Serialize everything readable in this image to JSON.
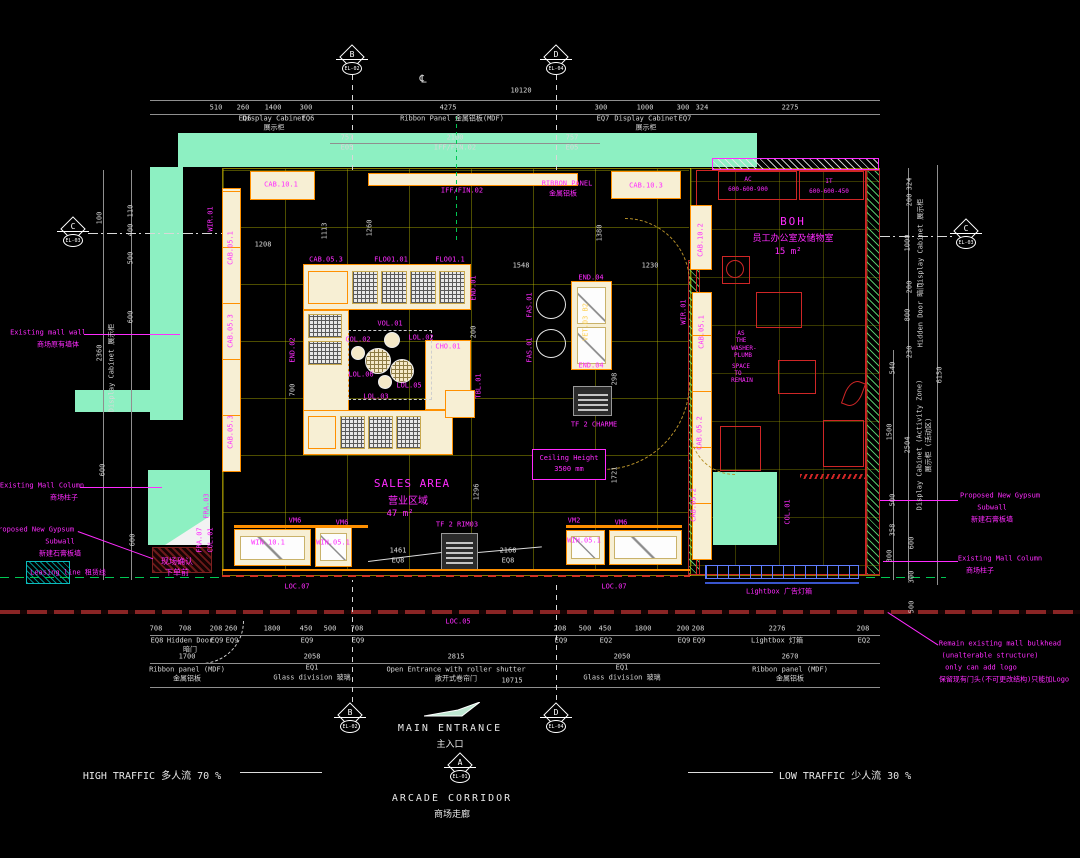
{
  "colors": {
    "wall_green": "#8df0c2",
    "magenta": "#ff00ff",
    "cad_yellow": "#ffff00",
    "cabinet_fill": "#f7efd4",
    "cabinet_border": "#ff9000",
    "red": "#cf2626",
    "lightbox_blue": "#5f7dff",
    "leasing_green": "#00c853"
  },
  "markers": [
    {
      "letter": "B",
      "code": "EL-02"
    },
    {
      "letter": "D",
      "code": "EL-04"
    },
    {
      "letter": "C",
      "code": "EL-03"
    },
    {
      "letter": "C",
      "code": "EL-03"
    },
    {
      "letter": "B",
      "code": "EL-02"
    },
    {
      "letter": "D",
      "code": "EL-04"
    },
    {
      "letter": "A",
      "code": "EL-01"
    }
  ],
  "traffic": {
    "high": "HIGH TRAFFIC 多人流 70 %",
    "low": "LOW TRAFFIC 少人流 30 %"
  },
  "entrance": {
    "main": "MAIN ENTRANCE",
    "main_cn": "主入口",
    "corridor": "ARCADE CORRIDOR",
    "corridor_cn": "商场走廊"
  },
  "rooms": {
    "sales": {
      "name": "SALES AREA",
      "cn": "营业区域",
      "area": "47 m²"
    },
    "boh": {
      "name": "BOH",
      "cn": "员工办公室及储物室",
      "area": "15 m²"
    },
    "ceiling": {
      "l1": "Ceiling Height",
      "l2": "3500 mm"
    }
  },
  "labels": [
    {
      "t": "10120",
      "x": 521,
      "y": 91
    },
    {
      "t": "510",
      "x": 216,
      "y": 108
    },
    {
      "t": "260",
      "x": 243,
      "y": 108
    },
    {
      "t": "EQ6",
      "x": 245,
      "y": 119
    },
    {
      "t": "1400",
      "x": 273,
      "y": 108
    },
    {
      "t": "Display Cabinet",
      "x": 274,
      "y": 119
    },
    {
      "t": "展示柜",
      "x": 274,
      "y": 128
    },
    {
      "t": "300",
      "x": 306,
      "y": 108
    },
    {
      "t": "EQ6",
      "x": 308,
      "y": 119
    },
    {
      "t": "757",
      "x": 347,
      "y": 138
    },
    {
      "t": "E05",
      "x": 347,
      "y": 148
    },
    {
      "t": "4275",
      "x": 448,
      "y": 108
    },
    {
      "t": "Ribbon Panel 金属铝板(MDF)",
      "x": 452,
      "y": 119
    },
    {
      "t": "2100",
      "x": 455,
      "y": 138
    },
    {
      "t": "IFF/FIN.02",
      "x": 455,
      "y": 148
    },
    {
      "t": "757",
      "x": 572,
      "y": 138
    },
    {
      "t": "E05",
      "x": 572,
      "y": 148
    },
    {
      "t": "300",
      "x": 601,
      "y": 108
    },
    {
      "t": "EQ7",
      "x": 603,
      "y": 119
    },
    {
      "t": "1000",
      "x": 645,
      "y": 108
    },
    {
      "t": "Display Cabinet",
      "x": 646,
      "y": 119
    },
    {
      "t": "展示柜",
      "x": 646,
      "y": 128
    },
    {
      "t": "300",
      "x": 683,
      "y": 108
    },
    {
      "t": "EQ7",
      "x": 685,
      "y": 119
    },
    {
      "t": "324",
      "x": 702,
      "y": 108
    },
    {
      "t": "2275",
      "x": 790,
      "y": 108
    },
    {
      "t": "℄",
      "x": 423,
      "y": 79,
      "s": 11
    },
    {
      "t": "100",
      "x": 100,
      "y": 218,
      "r": 1
    },
    {
      "t": "110",
      "x": 131,
      "y": 211,
      "r": 1
    },
    {
      "t": "400",
      "x": 131,
      "y": 230,
      "r": 1
    },
    {
      "t": "500",
      "x": 131,
      "y": 258,
      "r": 1
    },
    {
      "t": "600",
      "x": 131,
      "y": 317,
      "r": 1
    },
    {
      "t": "2360",
      "x": 100,
      "y": 353,
      "r": 1
    },
    {
      "t": "Display Cabinet 展示柜",
      "x": 112,
      "y": 368,
      "r": 1
    },
    {
      "t": "600",
      "x": 103,
      "y": 470,
      "r": 1
    },
    {
      "t": "600",
      "x": 133,
      "y": 540,
      "r": 1
    },
    {
      "t": "324",
      "x": 910,
      "y": 184,
      "r": 1
    },
    {
      "t": "200",
      "x": 910,
      "y": 200,
      "r": 1
    },
    {
      "t": "1000",
      "x": 908,
      "y": 243,
      "r": 1
    },
    {
      "t": "Display Cabinet 展示柜",
      "x": 921,
      "y": 243,
      "r": 1
    },
    {
      "t": "200",
      "x": 910,
      "y": 287,
      "r": 1
    },
    {
      "t": "800",
      "x": 908,
      "y": 315,
      "r": 1
    },
    {
      "t": "Hidden Door 暗门",
      "x": 921,
      "y": 315,
      "r": 1
    },
    {
      "t": "230",
      "x": 910,
      "y": 352,
      "r": 1
    },
    {
      "t": "540",
      "x": 893,
      "y": 368,
      "r": 1
    },
    {
      "t": "6150",
      "x": 940,
      "y": 375,
      "r": 1
    },
    {
      "t": "1500",
      "x": 890,
      "y": 432,
      "r": 1
    },
    {
      "t": "2504",
      "x": 908,
      "y": 445,
      "r": 1
    },
    {
      "t": "Display Cabinet (Activity Zone)",
      "x": 920,
      "y": 445,
      "r": 1
    },
    {
      "t": "展示柜 (活动区)",
      "x": 929,
      "y": 445,
      "r": 1
    },
    {
      "t": "500",
      "x": 893,
      "y": 500,
      "r": 1
    },
    {
      "t": "358",
      "x": 893,
      "y": 530,
      "r": 1
    },
    {
      "t": "300",
      "x": 890,
      "y": 556,
      "r": 1
    },
    {
      "t": "600",
      "x": 912,
      "y": 543,
      "r": 1
    },
    {
      "t": "300",
      "x": 912,
      "y": 577,
      "r": 1
    },
    {
      "t": "500",
      "x": 912,
      "y": 607,
      "r": 1
    },
    {
      "t": "708",
      "x": 156,
      "y": 629
    },
    {
      "t": "EQ8",
      "x": 157,
      "y": 641
    },
    {
      "t": "708",
      "x": 185,
      "y": 629
    },
    {
      "t": "Hidden Door",
      "x": 190,
      "y": 641
    },
    {
      "t": "暗门",
      "x": 190,
      "y": 650
    },
    {
      "t": "208",
      "x": 216,
      "y": 629
    },
    {
      "t": "EQ9",
      "x": 217,
      "y": 641
    },
    {
      "t": "260",
      "x": 231,
      "y": 629
    },
    {
      "t": "EQ9",
      "x": 232,
      "y": 641
    },
    {
      "t": "1800",
      "x": 272,
      "y": 629
    },
    {
      "t": "450",
      "x": 306,
      "y": 629
    },
    {
      "t": "EQ9",
      "x": 307,
      "y": 641
    },
    {
      "t": "500",
      "x": 330,
      "y": 629
    },
    {
      "t": "708",
      "x": 357,
      "y": 629
    },
    {
      "t": "EQ9",
      "x": 358,
      "y": 641
    },
    {
      "t": "208",
      "x": 560,
      "y": 629
    },
    {
      "t": "EQ9",
      "x": 561,
      "y": 641
    },
    {
      "t": "500",
      "x": 585,
      "y": 629
    },
    {
      "t": "450",
      "x": 605,
      "y": 629
    },
    {
      "t": "EQ2",
      "x": 606,
      "y": 641
    },
    {
      "t": "1800",
      "x": 643,
      "y": 629
    },
    {
      "t": "200",
      "x": 683,
      "y": 629
    },
    {
      "t": "EQ9",
      "x": 684,
      "y": 641
    },
    {
      "t": "208",
      "x": 698,
      "y": 629
    },
    {
      "t": "EQ9",
      "x": 699,
      "y": 641
    },
    {
      "t": "2276",
      "x": 777,
      "y": 629
    },
    {
      "t": "Lightbox 灯箱",
      "x": 777,
      "y": 641
    },
    {
      "t": "208",
      "x": 863,
      "y": 629
    },
    {
      "t": "EQ2",
      "x": 864,
      "y": 641
    },
    {
      "t": "1700",
      "x": 187,
      "y": 657
    },
    {
      "t": "Ribbon panel (MDF)",
      "x": 187,
      "y": 670
    },
    {
      "t": "金属铝板",
      "x": 187,
      "y": 679
    },
    {
      "t": "2058",
      "x": 312,
      "y": 657
    },
    {
      "t": "EQ1",
      "x": 312,
      "y": 668
    },
    {
      "t": "Glass division 玻璃",
      "x": 312,
      "y": 678
    },
    {
      "t": "2815",
      "x": 456,
      "y": 657
    },
    {
      "t": "Open Entrance with roller shutter",
      "x": 456,
      "y": 670
    },
    {
      "t": "敞开式卷帘门",
      "x": 456,
      "y": 679
    },
    {
      "t": "2050",
      "x": 622,
      "y": 657
    },
    {
      "t": "EQ1",
      "x": 622,
      "y": 668
    },
    {
      "t": "Glass division 玻璃",
      "x": 622,
      "y": 678
    },
    {
      "t": "2670",
      "x": 790,
      "y": 657
    },
    {
      "t": "Ribbon panel (MDF)",
      "x": 790,
      "y": 670
    },
    {
      "t": "金属铝板",
      "x": 790,
      "y": 679
    },
    {
      "t": "10715",
      "x": 512,
      "y": 681
    },
    {
      "t": "1208",
      "x": 263,
      "y": 245
    },
    {
      "t": "1113",
      "x": 325,
      "y": 231,
      "r": 1
    },
    {
      "t": "1260",
      "x": 370,
      "y": 228,
      "r": 1
    },
    {
      "t": "1548",
      "x": 521,
      "y": 266
    },
    {
      "t": "1230",
      "x": 650,
      "y": 266
    },
    {
      "t": "1380",
      "x": 600,
      "y": 233,
      "r": 1
    },
    {
      "t": "700",
      "x": 293,
      "y": 390,
      "r": 1
    },
    {
      "t": "200",
      "x": 474,
      "y": 332,
      "r": 1
    },
    {
      "t": "298",
      "x": 615,
      "y": 379,
      "r": 1
    },
    {
      "t": "1461",
      "x": 398,
      "y": 551
    },
    {
      "t": "EQ8",
      "x": 398,
      "y": 561
    },
    {
      "t": "2168",
      "x": 508,
      "y": 551
    },
    {
      "t": "EQ8",
      "x": 508,
      "y": 561
    },
    {
      "t": "1296",
      "x": 477,
      "y": 492,
      "r": 1
    },
    {
      "t": "1721",
      "x": 615,
      "y": 475,
      "r": 1
    },
    {
      "t": "CAB.10.1",
      "x": 281,
      "y": 185,
      "c": "m",
      "n": "cab-10-1-label"
    },
    {
      "t": "RIBBON PANEL",
      "x": 567,
      "y": 184,
      "c": "m"
    },
    {
      "t": "金属铝板",
      "x": 563,
      "y": 194,
      "c": "m"
    },
    {
      "t": "IFF/FIN.02",
      "x": 462,
      "y": 191,
      "c": "m"
    },
    {
      "t": "CAB.10.3",
      "x": 646,
      "y": 186,
      "c": "m"
    },
    {
      "t": "CAB.10.2",
      "x": 701,
      "y": 240,
      "c": "m",
      "r": 1
    },
    {
      "t": "WIR.01",
      "x": 211,
      "y": 219,
      "c": "m",
      "r": 1
    },
    {
      "t": "CAB.05.1",
      "x": 231,
      "y": 248,
      "c": "m",
      "r": 1
    },
    {
      "t": "CAB.05.3",
      "x": 231,
      "y": 331,
      "c": "m",
      "r": 1
    },
    {
      "t": "CAB.05.3",
      "x": 231,
      "y": 432,
      "c": "m",
      "r": 1
    },
    {
      "t": "CAB.05.3",
      "x": 326,
      "y": 260,
      "c": "m"
    },
    {
      "t": "FLO01.01",
      "x": 391,
      "y": 260,
      "c": "m"
    },
    {
      "t": "FLO01.1",
      "x": 450,
      "y": 260,
      "c": "m"
    },
    {
      "t": "END.01",
      "x": 474,
      "y": 288,
      "c": "m",
      "r": 1
    },
    {
      "t": "END.02",
      "x": 293,
      "y": 350,
      "c": "m",
      "r": 1
    },
    {
      "t": "VOL.01",
      "x": 390,
      "y": 324,
      "c": "m"
    },
    {
      "t": "COL.02",
      "x": 358,
      "y": 340,
      "c": "m"
    },
    {
      "t": "LOL.02",
      "x": 421,
      "y": 338,
      "c": "m"
    },
    {
      "t": "CHO.01",
      "x": 448,
      "y": 347,
      "c": "m"
    },
    {
      "t": "LOL.06",
      "x": 361,
      "y": 375,
      "c": "m"
    },
    {
      "t": "LOL.05",
      "x": 409,
      "y": 386,
      "c": "m"
    },
    {
      "t": "LOL.03",
      "x": 376,
      "y": 397,
      "c": "m"
    },
    {
      "t": "TBL.01",
      "x": 479,
      "y": 386,
      "c": "m",
      "r": 1
    },
    {
      "t": "END.04",
      "x": 591,
      "y": 278,
      "c": "m"
    },
    {
      "t": "END.04",
      "x": 591,
      "y": 366,
      "c": "m"
    },
    {
      "t": "VET.03 B2",
      "x": 586,
      "y": 322,
      "c": "y",
      "r": 1
    },
    {
      "t": "FAS.01",
      "x": 530,
      "y": 305,
      "c": "m",
      "r": 1
    },
    {
      "t": "FAS.01",
      "x": 530,
      "y": 350,
      "c": "m",
      "r": 1
    },
    {
      "t": "TF 2 CHARME",
      "x": 594,
      "y": 425,
      "c": "m"
    },
    {
      "t": "WIR.01",
      "x": 684,
      "y": 312,
      "c": "m",
      "r": 1
    },
    {
      "t": "CAB.05.1",
      "x": 702,
      "y": 332,
      "c": "m",
      "r": 1
    },
    {
      "t": "CAB.05.2",
      "x": 700,
      "y": 433,
      "c": "m",
      "r": 1
    },
    {
      "t": "CAB.05.2",
      "x": 694,
      "y": 505,
      "c": "m",
      "r": 1
    },
    {
      "t": "VM6",
      "x": 295,
      "y": 521,
      "c": "m"
    },
    {
      "t": "VM6",
      "x": 342,
      "y": 523,
      "c": "m"
    },
    {
      "t": "WIN.10.1",
      "x": 268,
      "y": 543,
      "c": "m"
    },
    {
      "t": "WIN.05.1",
      "x": 333,
      "y": 543,
      "c": "m"
    },
    {
      "t": "TF 2 RIM03",
      "x": 457,
      "y": 525,
      "c": "m"
    },
    {
      "t": "VM2",
      "x": 574,
      "y": 521,
      "c": "m"
    },
    {
      "t": "VM6",
      "x": 621,
      "y": 523,
      "c": "m"
    },
    {
      "t": "WIH.05.1",
      "x": 584,
      "y": 541,
      "c": "m"
    },
    {
      "t": "LOC.07",
      "x": 297,
      "y": 587,
      "c": "m"
    },
    {
      "t": "LOC.07",
      "x": 614,
      "y": 587,
      "c": "m"
    },
    {
      "t": "LOC.05",
      "x": 458,
      "y": 622,
      "c": "m"
    },
    {
      "t": "Lightbox 广告灯箱",
      "x": 779,
      "y": 592,
      "c": "m"
    },
    {
      "t": "FRA.03",
      "x": 207,
      "y": 506,
      "c": "m",
      "r": 1
    },
    {
      "t": "FRA.07",
      "x": 200,
      "y": 540,
      "c": "m",
      "r": 1
    },
    {
      "t": "COL.01",
      "x": 211,
      "y": 540,
      "c": "m",
      "r": 1
    },
    {
      "t": "COL.01",
      "x": 788,
      "y": 512,
      "c": "m",
      "r": 1
    },
    {
      "t": "现场确认",
      "x": 177,
      "y": 562,
      "c": "m",
      "s": 8
    },
    {
      "t": "下单前",
      "x": 177,
      "y": 573,
      "c": "m",
      "s": 8
    },
    {
      "t": "AC",
      "x": 748,
      "y": 180,
      "c": "m",
      "s": 6
    },
    {
      "t": "600-600-900",
      "x": 748,
      "y": 190,
      "c": "m",
      "s": 6
    },
    {
      "t": "IT",
      "x": 829,
      "y": 182,
      "c": "m",
      "s": 6
    },
    {
      "t": "600-600-450",
      "x": 829,
      "y": 192,
      "c": "m",
      "s": 6
    },
    {
      "t": "AS",
      "x": 741,
      "y": 334,
      "c": "m",
      "s": 6
    },
    {
      "t": "THE",
      "x": 741,
      "y": 341,
      "c": "m",
      "s": 6
    },
    {
      "t": "WASHER-",
      "x": 744,
      "y": 349,
      "c": "m",
      "s": 6
    },
    {
      "t": "PLUMB",
      "x": 743,
      "y": 356,
      "c": "m",
      "s": 6
    },
    {
      "t": "SPACE",
      "x": 741,
      "y": 367,
      "c": "m",
      "s": 6
    },
    {
      "t": "TO",
      "x": 738,
      "y": 374,
      "c": "m",
      "s": 6
    },
    {
      "t": "REMAIN",
      "x": 742,
      "y": 381,
      "c": "m",
      "s": 6
    },
    {
      "t": "Existing mall wall",
      "x": 48,
      "y": 333,
      "c": "m",
      "n": "annotation-existing-mall-wall"
    },
    {
      "t": "商场原有墙体",
      "x": 58,
      "y": 345,
      "c": "m"
    },
    {
      "t": "Existing Mall Column",
      "x": 42,
      "y": 486,
      "c": "m",
      "n": "annotation-existing-mall-column-left"
    },
    {
      "t": "商场柱子",
      "x": 64,
      "y": 498,
      "c": "m"
    },
    {
      "t": "Proposed New Gypsum",
      "x": 34,
      "y": 530,
      "c": "m",
      "n": "annotation-proposed-gypsum-left"
    },
    {
      "t": "Subwall",
      "x": 60,
      "y": 542,
      "c": "m"
    },
    {
      "t": "新建石膏板墙",
      "x": 60,
      "y": 554,
      "c": "m"
    },
    {
      "t": "Leasing line 租赁线",
      "x": 68,
      "y": 573,
      "c": "m",
      "n": "annotation-leasing-line"
    },
    {
      "t": "Proposed New Gypsum",
      "x": 1000,
      "y": 496,
      "c": "m",
      "n": "annotation-proposed-gypsum-right"
    },
    {
      "t": "Subwall",
      "x": 992,
      "y": 508,
      "c": "m"
    },
    {
      "t": "新建石膏板墙",
      "x": 992,
      "y": 520,
      "c": "m"
    },
    {
      "t": "Existing Mall Column",
      "x": 1000,
      "y": 559,
      "c": "m",
      "n": "annotation-existing-mall-column-right"
    },
    {
      "t": "商场柱子",
      "x": 980,
      "y": 571,
      "c": "m"
    },
    {
      "t": "Remain existing mall bulkhead",
      "x": 1000,
      "y": 644,
      "c": "m",
      "n": "annotation-bulkhead-note"
    },
    {
      "t": "(unalterable structure)",
      "x": 990,
      "y": 656,
      "c": "m"
    },
    {
      "t": "only can add logo",
      "x": 981,
      "y": 668,
      "c": "m"
    },
    {
      "t": "保留现有门头(不可更改结构)只能加Logo",
      "x": 1004,
      "y": 680,
      "c": "m"
    }
  ]
}
